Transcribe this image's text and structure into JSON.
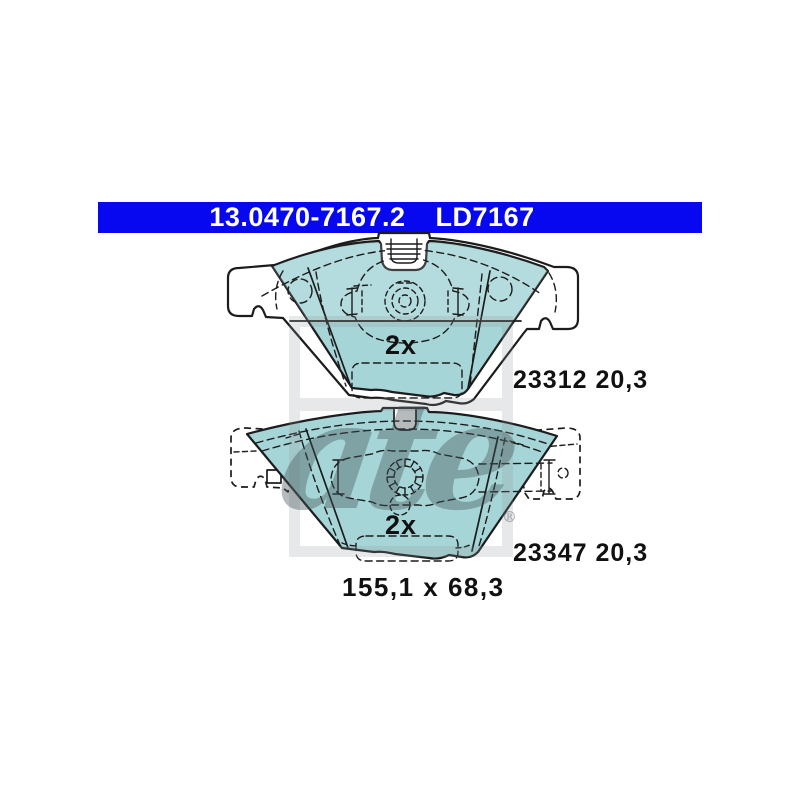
{
  "header": {
    "part_number": "13.0470-7167.2",
    "reference": "LD7167"
  },
  "drawings": {
    "top": {
      "quantity": "2x",
      "reference": "23312 20,3"
    },
    "bottom": {
      "quantity": "2x",
      "reference": "23347 20,3"
    },
    "dimensions": "155,1 x 68,3"
  },
  "watermark": {
    "brand": "ate",
    "registered": "®"
  },
  "colors": {
    "background": "#ffffff",
    "header_bg": "#0808f0",
    "header_text": "#ffffff",
    "pad_fill": "#a6d5d7",
    "line_color": "#1c1c1c",
    "label_color": "#111111",
    "watermark_color": "rgba(145,150,154,0.22)",
    "watermark_ink": "rgba(70,85,90,0.40)"
  }
}
